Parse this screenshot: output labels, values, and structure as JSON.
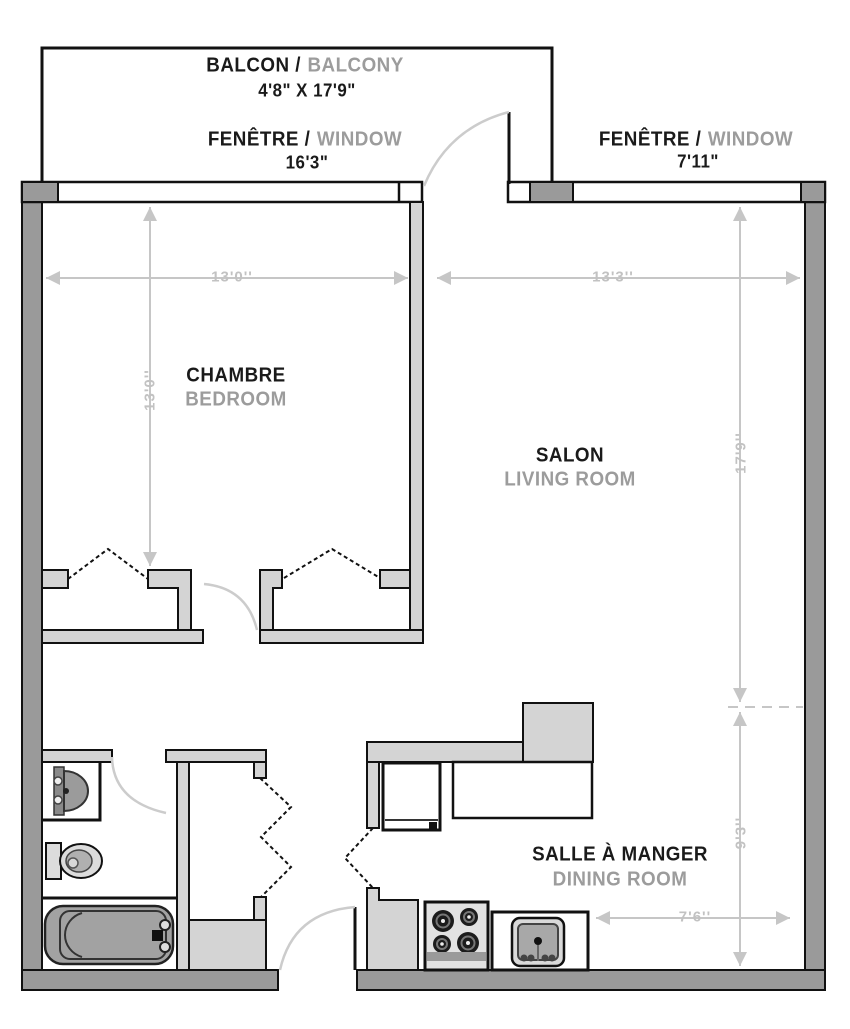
{
  "rooms": {
    "balcony": {
      "name_fr": "BALCON /",
      "name_en": "BALCONY",
      "dimensions": "4'8\" X 17'9\""
    },
    "window_left": {
      "name_fr": "FENÊTRE /",
      "name_en": "WINDOW",
      "dimensions": "16'3\""
    },
    "window_right": {
      "name_fr": "FENÊTRE /",
      "name_en": "WINDOW",
      "dimensions": "7'11\""
    },
    "bedroom": {
      "name_fr": "CHAMBRE",
      "name_en": "BEDROOM",
      "width": "13'0''",
      "depth": "13'0''"
    },
    "living_room": {
      "name_fr": "SALON",
      "name_en": "LIVING ROOM",
      "width": "13'3''",
      "depth": "17'9''"
    },
    "dining_room": {
      "name_fr": "SALLE À MANGER",
      "name_en": "DINING ROOM",
      "width": "7'6''",
      "depth": "9'3''"
    }
  },
  "colors": {
    "outer_wall": "#9a9a9a",
    "inner_wall": "#d4d4d4",
    "outline": "#111111",
    "dimension_gray": "#c6c6c6",
    "label_primary": "#1a1a1a",
    "label_secondary": "#9c9c9c",
    "fixture_gray": "#a2a2a2"
  }
}
